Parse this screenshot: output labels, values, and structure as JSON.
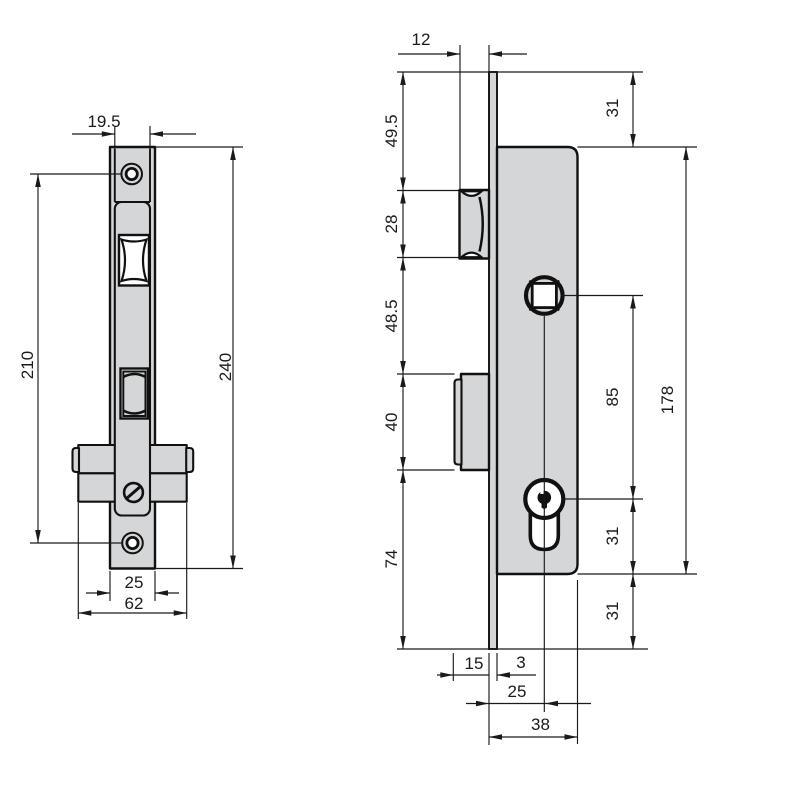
{
  "meta": {
    "title": "Mortise lock dimensional drawing",
    "units": "mm"
  },
  "front_view": {
    "label": "front view",
    "dims": {
      "case_width": "19.5",
      "screw_spacing": "210",
      "total_height": "240",
      "faceplate_width": "25",
      "housing_width": "62"
    }
  },
  "side_view": {
    "label": "side view",
    "dims": {
      "latch_protrusion": "12",
      "plate_top_to_latch": "49.5",
      "latch_height": "28",
      "latch_to_deadbolt": "48.5",
      "deadbolt_height": "40",
      "deadbolt_to_plate_bottom": "74",
      "plate_top_to_case": "31",
      "case_height": "178",
      "spindle_to_cylinder": "85",
      "cylinder_to_case_bottom": "31",
      "case_bottom_to_plate": "31",
      "deadbolt_throw": "15",
      "faceplate_thickness": "3",
      "backset": "25",
      "case_depth": "38"
    }
  },
  "colors": {
    "metal_fill": "#d4d6d7",
    "outline": "#111111",
    "dimension_lines": "#1a1a1a",
    "background": "#ffffff"
  }
}
